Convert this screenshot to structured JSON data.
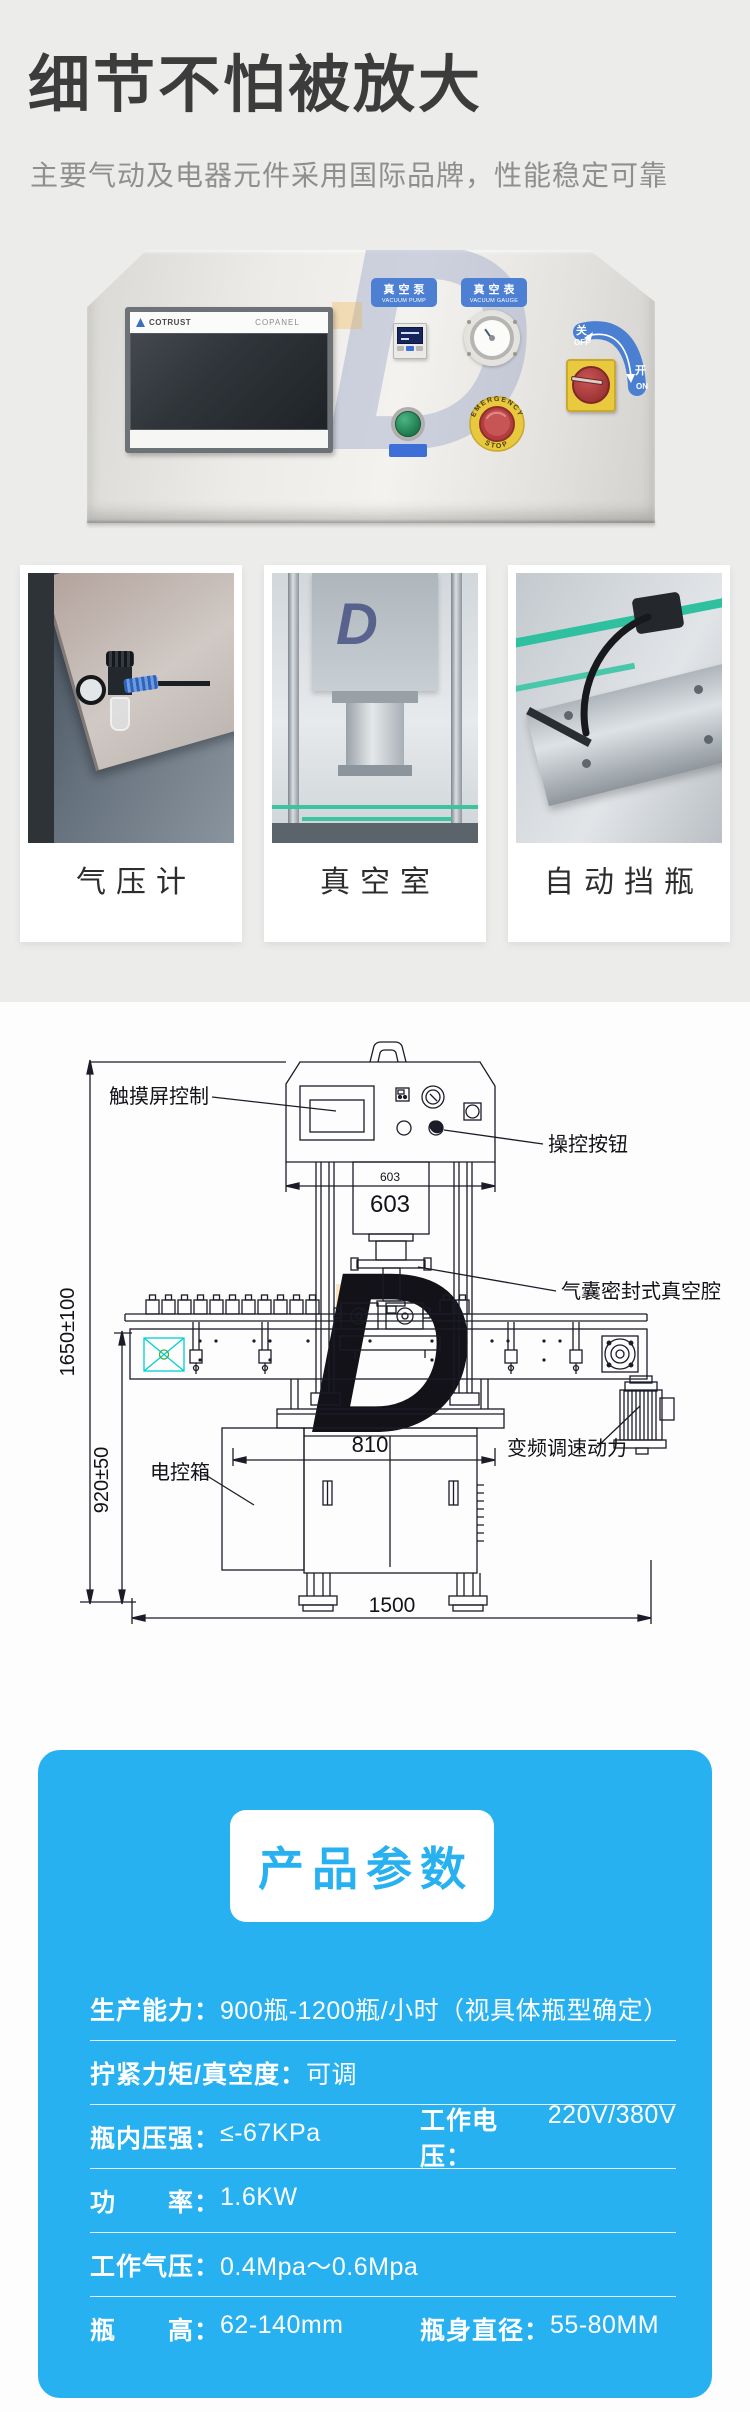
{
  "header": {
    "title": "细节不怕被放大",
    "subtitle": "主要气动及电器元件采用国际品牌，性能稳定可靠"
  },
  "panel": {
    "hmi_brand": "COTRUST",
    "hmi_model": "COPANEL",
    "vacuum_pump_cn": "真空泵",
    "vacuum_pump_en": "VACUUM PUMP",
    "vacuum_gauge_cn": "真空表",
    "vacuum_gauge_en": "VACUUM GAUGE",
    "off_cn": "关",
    "off_en": "OFF",
    "on_cn": "开",
    "on_en": "ON",
    "estop_top": "EMERGENCY",
    "estop_bottom": "STOP",
    "watermark": "D"
  },
  "feature_cards": [
    {
      "caption": "气压计"
    },
    {
      "caption": "真空室"
    },
    {
      "caption": "自动挡瓶"
    }
  ],
  "diagram": {
    "watermark": "D",
    "labels": {
      "touch_screen": "触摸屏控制",
      "control_buttons": "操控按钮",
      "vacuum_chamber": "气囊密封式真空腔",
      "electric_box": "电控箱",
      "vfd_power": "变频调速动力"
    },
    "dims": {
      "height_total": "1650±100",
      "height_conveyor": "920±50",
      "width_head": "603",
      "width_cabinet": "810",
      "width_total": "1500"
    }
  },
  "params": {
    "title": "产品参数",
    "rows": [
      {
        "cells": [
          {
            "label": "生产能力：",
            "value": "900瓶-1200瓶/小时（视具体瓶型确定）"
          }
        ]
      },
      {
        "cells": [
          {
            "label": "拧紧力矩/真空度：",
            "value": "可调"
          }
        ]
      },
      {
        "cells": [
          {
            "label": "瓶内压强：",
            "value": "≤-67KPa"
          },
          {
            "label": "工作电压：",
            "value": "220V/380V"
          }
        ]
      },
      {
        "cells": [
          {
            "label": "功　　率：",
            "value": "1.6KW"
          }
        ]
      },
      {
        "cells": [
          {
            "label": "工作气压：",
            "value": "0.4Mpa～0.6Mpa"
          }
        ]
      },
      {
        "cells": [
          {
            "label": "瓶　　高：",
            "value": "62-140mm"
          },
          {
            "label": "瓶身直径：",
            "value": "55-80MM"
          }
        ]
      }
    ]
  }
}
